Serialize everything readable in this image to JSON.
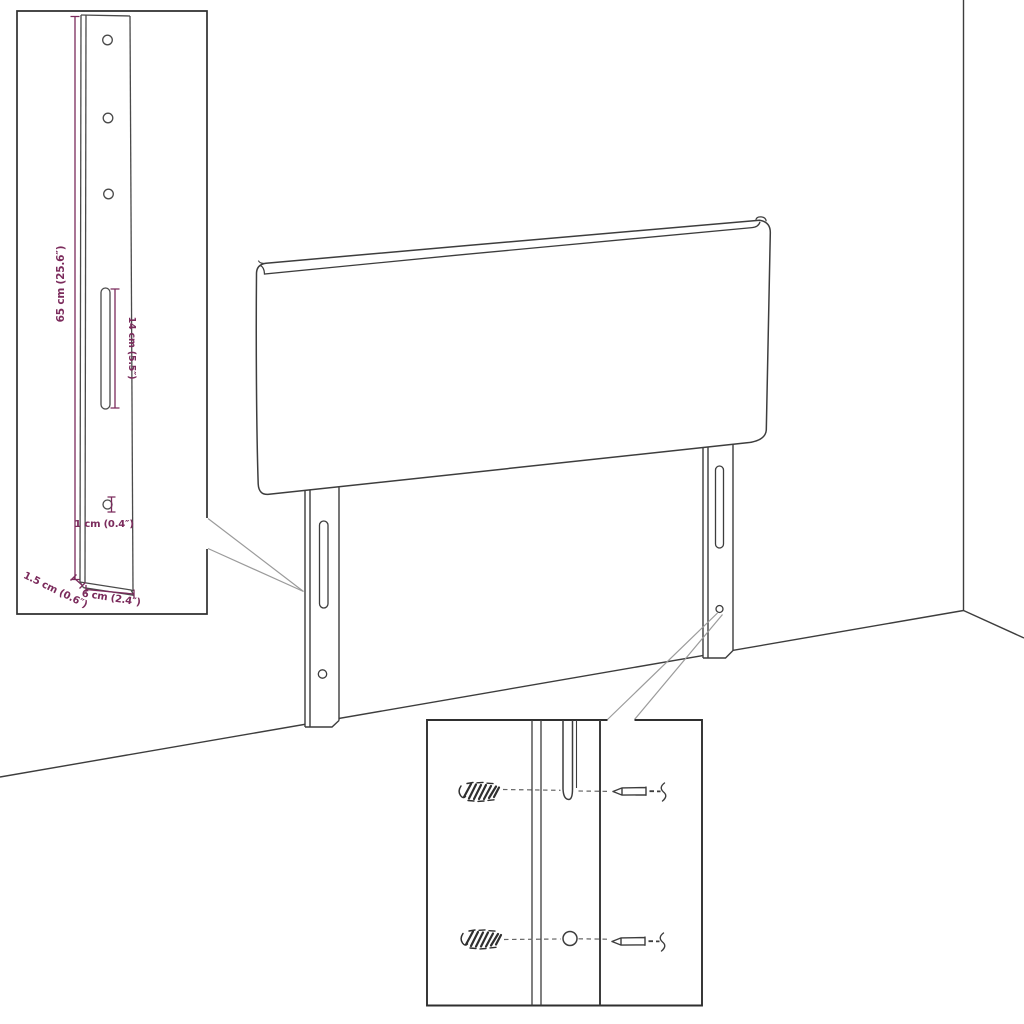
{
  "colors": {
    "background": "#ffffff",
    "outline": "#3d3d3d",
    "inset_border": "#2f2f2f",
    "callout_line": "#9b9b9b",
    "dimension_accent": "#7b2b5c"
  },
  "dimension_labels": {
    "bracket_height": "65 cm (25.6″)",
    "slot_length": "14 cm (5.5″)",
    "hole_diameter": "1 cm (0.4″)",
    "bracket_depth": "1.5 cm (0.6″)",
    "bracket_width": "6 cm (2.4″)"
  }
}
